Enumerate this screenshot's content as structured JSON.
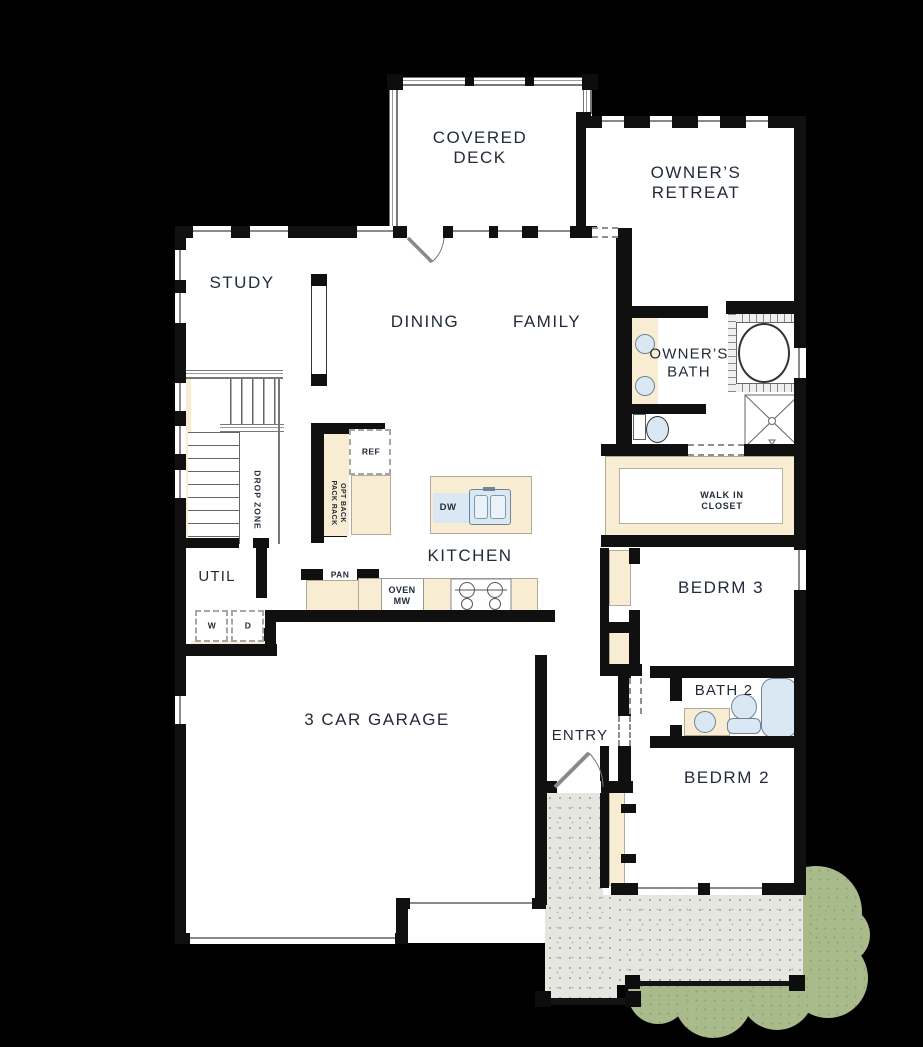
{
  "canvas": {
    "width": 923,
    "height": 1047
  },
  "rooms": {
    "covered_deck": "COVERED DECK",
    "owners_retreat": "OWNER’S RETREAT",
    "study": "STUDY",
    "dining": "DINING",
    "family": "FAMILY",
    "owners_bath": "OWNER’S BATH",
    "walk_in_closet": "WALK IN CLOSET",
    "kitchen": "KITCHEN",
    "util": "UTIL",
    "bedrm3": "BEDRM 3",
    "garage": "3 CAR GARAGE",
    "entry": "ENTRY",
    "bath2": "BATH 2",
    "bedrm2": "BEDRM 2"
  },
  "fixtures": {
    "ref": "REF",
    "dw": "DW",
    "pan": "PAN",
    "oven_mw": "OVEN MW",
    "washer": "W",
    "dryer": "D",
    "drop_zone": "DROP ZONE",
    "opt_rack": "OPT BACK PACK RACK"
  },
  "colors": {
    "background": "#000000",
    "wall": "#101010",
    "floor": "#ffffff",
    "counter": "#f8edd2",
    "fixture_blue": "#d9e8f3",
    "porch": "#e6e6e1",
    "shrub": "#a9ba8b",
    "label_text": "#222b3a"
  }
}
